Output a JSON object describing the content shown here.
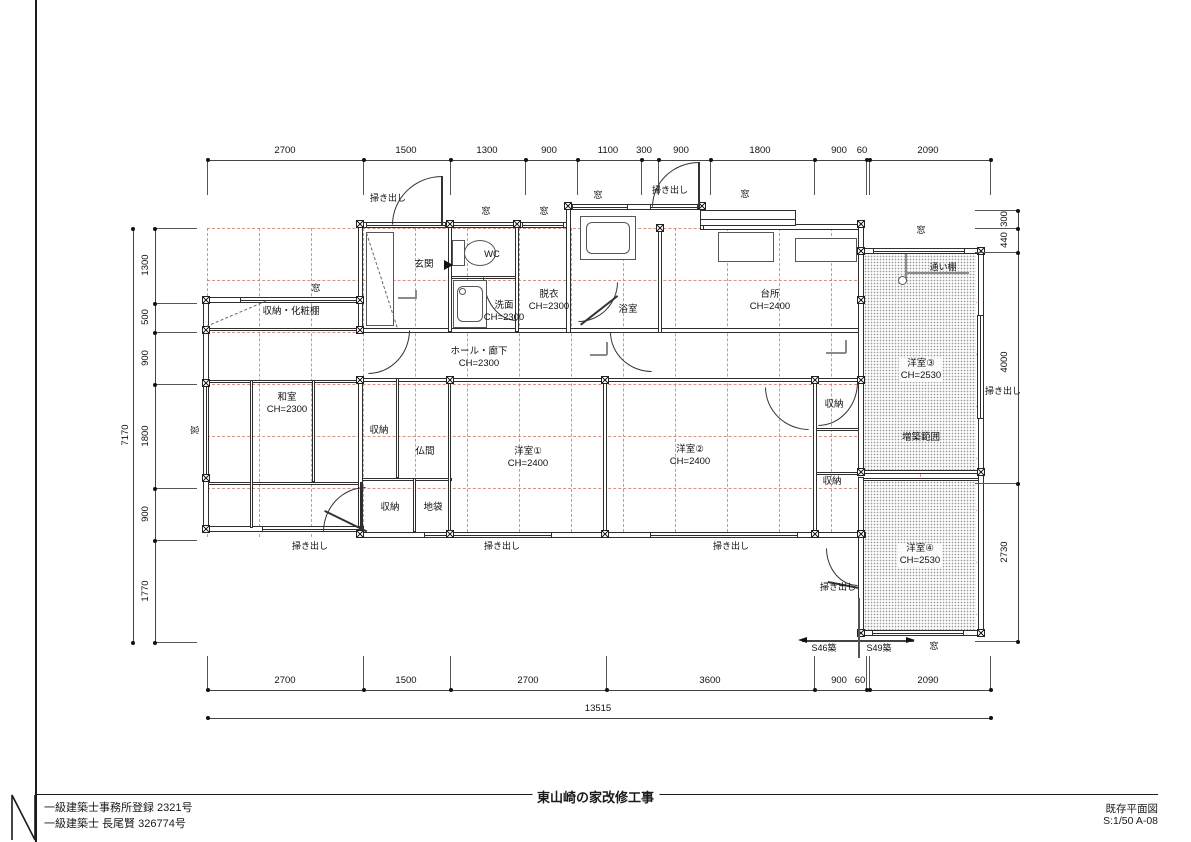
{
  "title_block": {
    "project_title": "東山崎の家改修工事",
    "license_1": "一級建築士事務所登録 2321号",
    "license_2": "一級建築士 長尾賢 326774号",
    "sheet_name": "既存平面図",
    "sheet_scale": "S:1/50  A-08"
  },
  "dims": {
    "top": [
      "2700",
      "1500",
      "1300",
      "900",
      "1100",
      "300",
      "900",
      "1800",
      "900",
      "60",
      "2090"
    ],
    "bottom": {
      "segs": [
        "2700",
        "1500",
        "2700",
        "3600",
        "900",
        "60",
        "2090"
      ],
      "total": "13515"
    },
    "left": {
      "segs": [
        "1300",
        "500",
        "900",
        "1800",
        "900",
        "1770"
      ],
      "total": "7170"
    },
    "right": [
      "300",
      "440",
      "4000",
      "2730"
    ]
  },
  "rooms": {
    "genkan": {
      "name": "玄関"
    },
    "wc": {
      "name": "WC"
    },
    "senmen": {
      "name": "洗面",
      "ch": "CH=2300"
    },
    "datsui": {
      "name": "脱衣",
      "ch": "CH=2300"
    },
    "yokushitsu": {
      "name": "浴室"
    },
    "daidokoro": {
      "name": "台所",
      "ch": "CH=2400"
    },
    "hall": {
      "name": "ホール・廊下",
      "ch": "CH=2300"
    },
    "shuno_kesho": {
      "name": "収納・化粧棚"
    },
    "washitsu": {
      "name": "和室",
      "ch": "CH=2300"
    },
    "shuno_a": {
      "name": "収納"
    },
    "butsuma": {
      "name": "仏間"
    },
    "shuno_b": {
      "name": "収納"
    },
    "jibukuro": {
      "name": "地袋"
    },
    "yoshitsu1": {
      "name": "洋室①",
      "ch": "CH=2400"
    },
    "yoshitsu2": {
      "name": "洋室②",
      "ch": "CH=2400"
    },
    "shuno_c": {
      "name": "収納"
    },
    "shuno_d": {
      "name": "収納"
    },
    "yoshitsu3": {
      "name": "洋室③",
      "ch": "CH=2530"
    },
    "yoshitsu4": {
      "name": "洋室④",
      "ch": "CH=2530"
    }
  },
  "openings": {
    "hakidashi": "掃き出し",
    "mado": "窓"
  },
  "annotations": {
    "zochiku": "増築範囲",
    "kayoidana": "通い棚",
    "s46": "S46築",
    "s49": "S49築"
  },
  "colors": {
    "grid": "#ca705c",
    "wall": "#2e2e2e",
    "accent_dash": "#cc7a66"
  }
}
